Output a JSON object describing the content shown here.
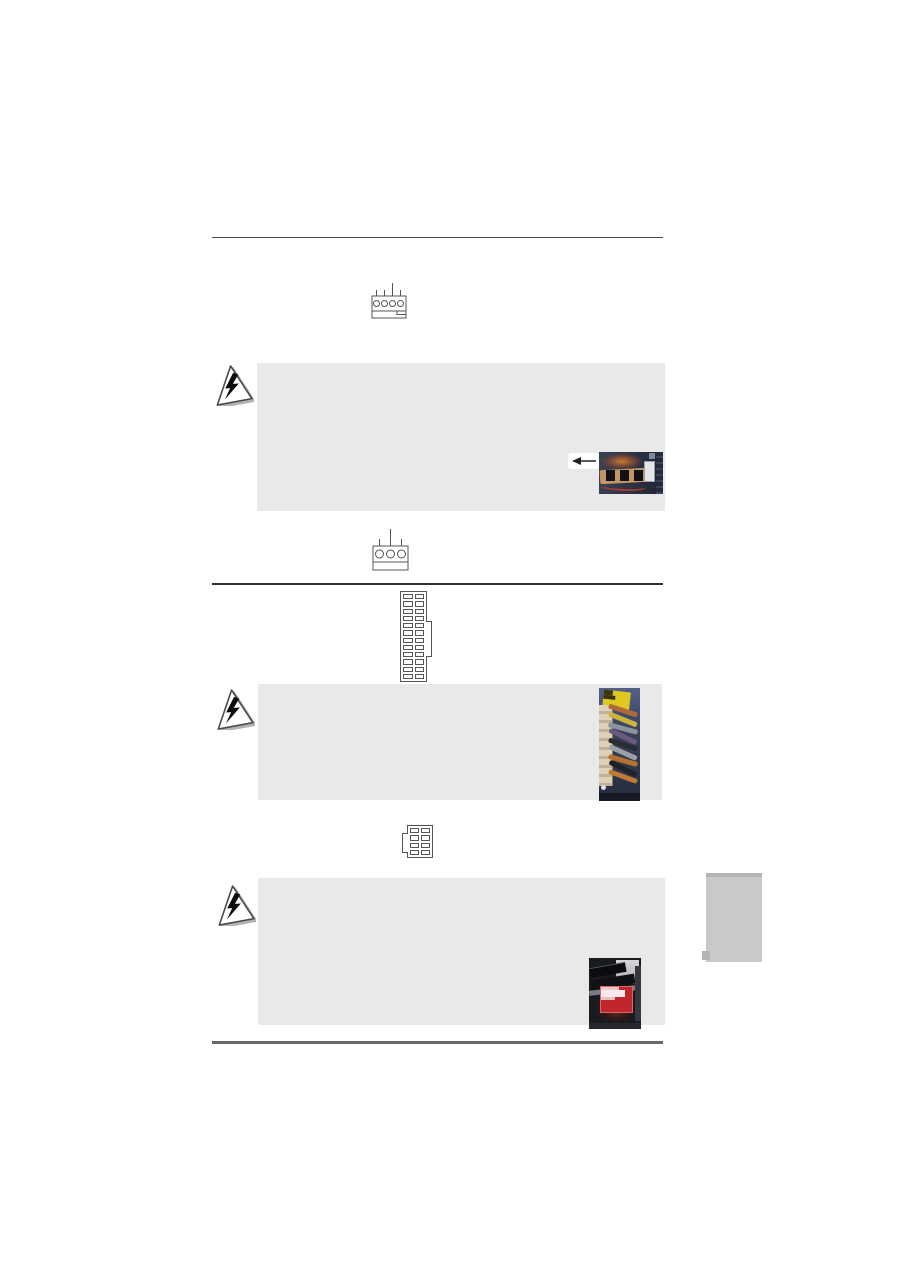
{
  "page": {
    "width": 900,
    "height": 1273,
    "kind": "motherboard-manual-page",
    "visible_text": ""
  },
  "colors": {
    "page_bg": "#ffffff",
    "note_bg": "#e9e9ea",
    "rule_top": "#4a4a4a",
    "rule_mid": "#303030",
    "rule_bottom": "#686868",
    "line_art": "#555555",
    "tab_bg": "#c9c9cb",
    "tab_edge": "#b5b5b7",
    "label_yellow": "#ddc91f",
    "label_red": "#c0272d"
  },
  "figures": {
    "fan_connector_4pin": {
      "type": "fan-header-line-diagram",
      "pins": 4
    },
    "fan_connector_3pin": {
      "type": "fan-header-line-diagram",
      "pins": 3
    },
    "atx_24pin": {
      "type": "power-connector-line-diagram",
      "cols": 2,
      "rows": 12,
      "latch_side": "right"
    },
    "atx_8pin": {
      "type": "power-connector-line-diagram",
      "cols": 2,
      "rows": 4,
      "latch_side": "left"
    }
  },
  "icons": [
    {
      "name": "warning-lightning-icon",
      "shape": "triangle-with-lightning-bolt",
      "count": 3
    },
    {
      "name": "left-arrow-icon",
      "glyph": "←"
    }
  ],
  "photos": [
    {
      "name": "fan-connector-photo",
      "content": "motherboard fan headers close-up"
    },
    {
      "name": "atx-power-cable-photo",
      "content": "24-pin ATX plug with colored wires, yellow sticker"
    },
    {
      "name": "8pin-power-photo",
      "content": "8-pin 12V header close-up, red sticker"
    }
  ],
  "caution_boxes": 3
}
